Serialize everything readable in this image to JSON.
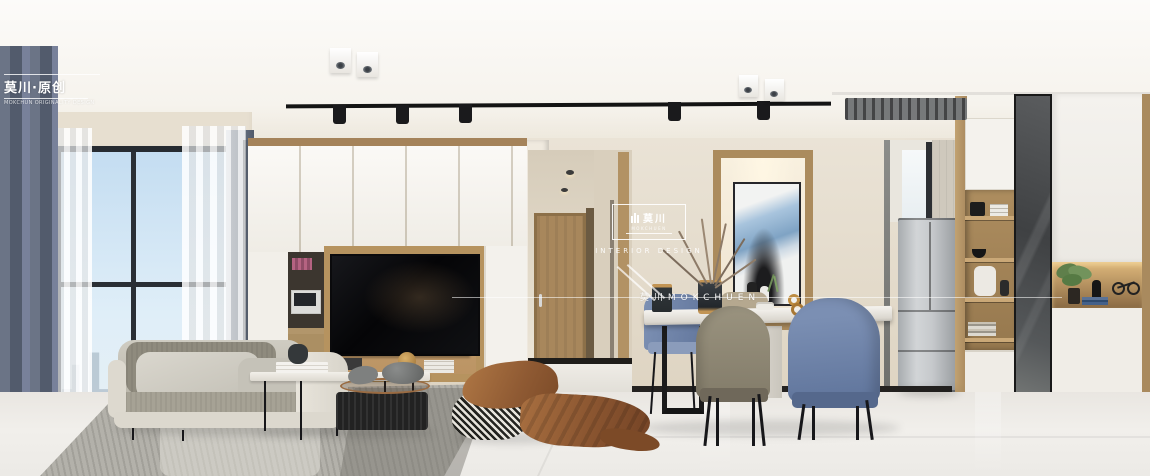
{
  "scene": {
    "description": "modern living-dining room interior render",
    "objects": [
      "window-city-view",
      "gray-curtain",
      "sheer-curtain",
      "tv-wall-cabinet",
      "tv",
      "desk-nook",
      "hallway-door",
      "abstract-art-niche",
      "dried-branch-vase",
      "dining-table",
      "dining-chairs",
      "refrigerator",
      "display-shelf-unit",
      "mirror-cabinet-door",
      "decor-niche",
      "shoe-niche",
      "sofa",
      "coffee-table-white",
      "coffee-table-black",
      "houndstooth-pouf",
      "brown-throw-blanket",
      "area-rug",
      "track-lighting",
      "ceiling-spotlights",
      "ac-vent"
    ]
  },
  "watermarks": {
    "top_left": {
      "title": "莫川·原创",
      "subtitle": "MOKCHUN ORIGINALITY DESIGN"
    },
    "center": {
      "logo_cn": "莫川",
      "logo_sub": "MOKCHUEN",
      "tagline": "INTERIOR DESIGN",
      "baseline": "莫川MOKCHUEN"
    }
  },
  "palette": {
    "wall_beige": "#e6ddcd",
    "wood": "#ad8c61",
    "cabinet_white": "#f4f2ed",
    "curtain_gray_blue": "#5d6677",
    "sky_blue": "#cfe4f4",
    "floor_marble": "#eae8e3",
    "rug_gray": "#b4b2ab",
    "sofa_cream": "#e2ded5",
    "chair_blue": "#6d82a8",
    "chair_taupe": "#8f8877",
    "blanket_caramel": "#a06a3e",
    "tv_black": "#0b0b0d",
    "accent_gold": "#c0914f"
  }
}
